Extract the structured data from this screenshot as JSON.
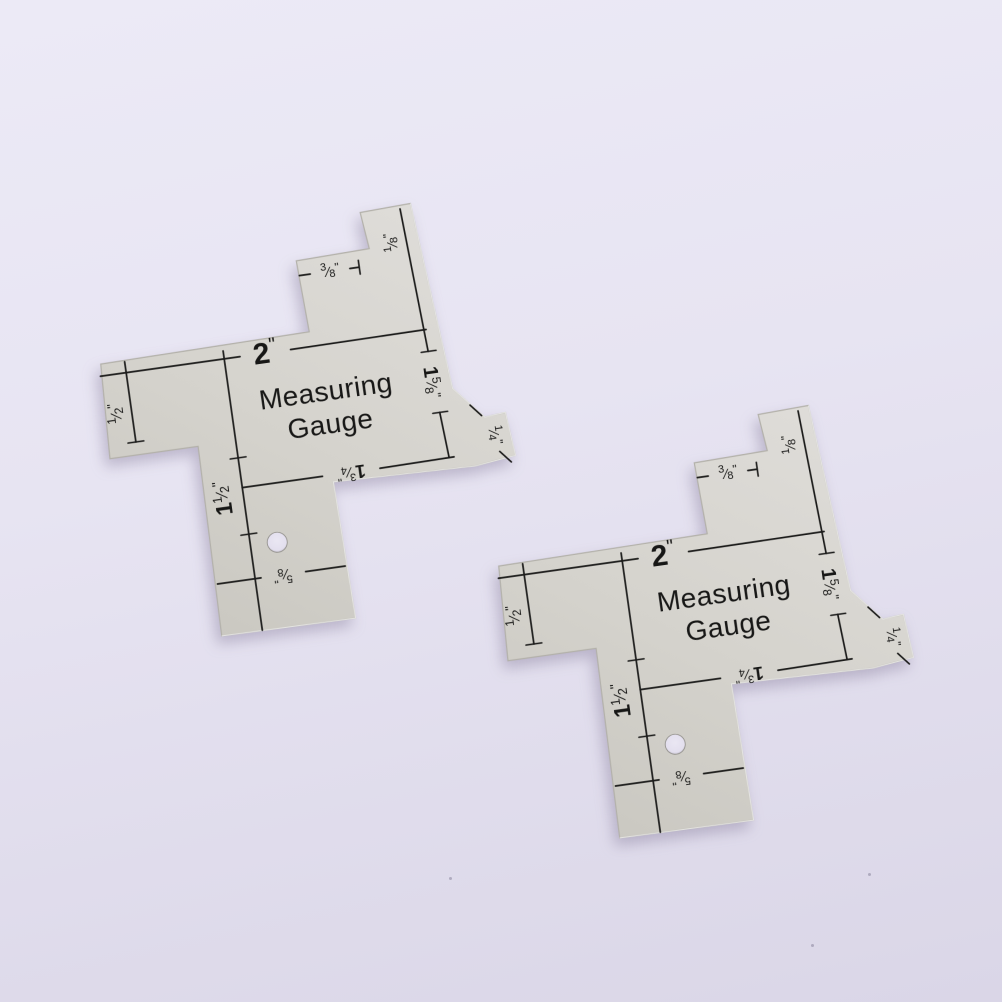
{
  "scene": {
    "description": "two identical metal sewing measuring gauges on lavender backdrop",
    "background_top_color": "#ecEAf6",
    "background_bottom_color": "#dad6e7",
    "plate_color": "#d6d4cf",
    "plate_edge_color": "#b3b1aa",
    "engraving_color": "#1b1b1a"
  },
  "gauge": {
    "title_line1": "Measuring",
    "title_line2": "Gauge",
    "unit": "\"",
    "slash": "⁄",
    "labels": {
      "two": {
        "whole": "2"
      },
      "three_eighths": {
        "num": "3",
        "den": "8"
      },
      "one_eighth": {
        "num": "1",
        "den": "8"
      },
      "one_five_eighths": {
        "whole": "1",
        "num": "5",
        "den": "8"
      },
      "half": {
        "num": "1",
        "den": "2"
      },
      "one_and_half": {
        "whole": "1",
        "num": "1",
        "den": "2"
      },
      "one_three_quarters": {
        "whole": "1",
        "num": "3",
        "den": "4"
      },
      "quarter": {
        "num": "1",
        "den": "4"
      },
      "five_eighths": {
        "num": "5",
        "den": "8"
      }
    }
  }
}
